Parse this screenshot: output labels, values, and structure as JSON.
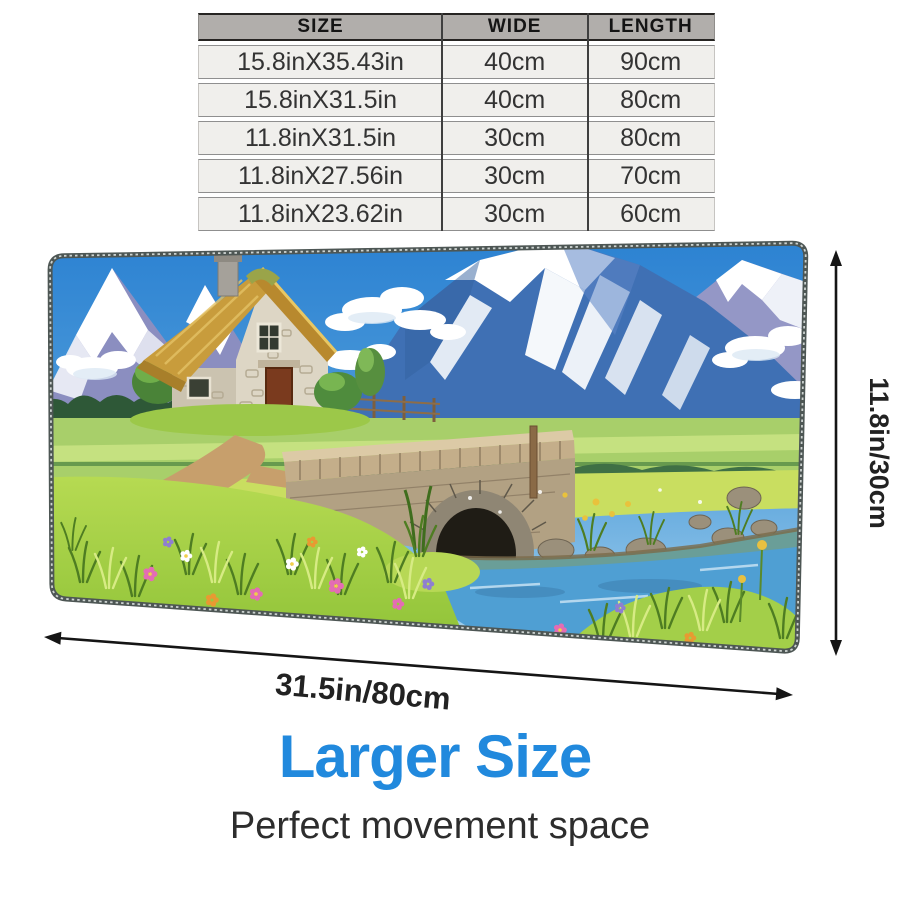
{
  "size_table": {
    "headers": [
      "SIZE",
      "WIDE",
      "LENGTH"
    ],
    "rows": [
      [
        "15.8inX35.43in",
        "40cm",
        "90cm"
      ],
      [
        "15.8inX31.5in",
        "40cm",
        "80cm"
      ],
      [
        "11.8inX31.5in",
        "30cm",
        "80cm"
      ],
      [
        "11.8inX27.56in",
        "30cm",
        "70cm"
      ],
      [
        "11.8inX23.62in",
        "30cm",
        "60cm"
      ]
    ]
  },
  "dimensions": {
    "height_label": "11.8in/30cm",
    "width_label": "31.5in/80cm"
  },
  "footer": {
    "title": "Larger Size",
    "subtitle": "Perfect movement space"
  },
  "artwork_alt": "Mouse pad with painted landscape: thatched stone cottage, snowy mountains, meadow with flowers, stone bridge over a river",
  "colors": {
    "accent_blue": "#2189dd",
    "table_header_bg": "#b1aeab",
    "table_row_bg": "#f0efec",
    "arrow_color": "#151515"
  }
}
